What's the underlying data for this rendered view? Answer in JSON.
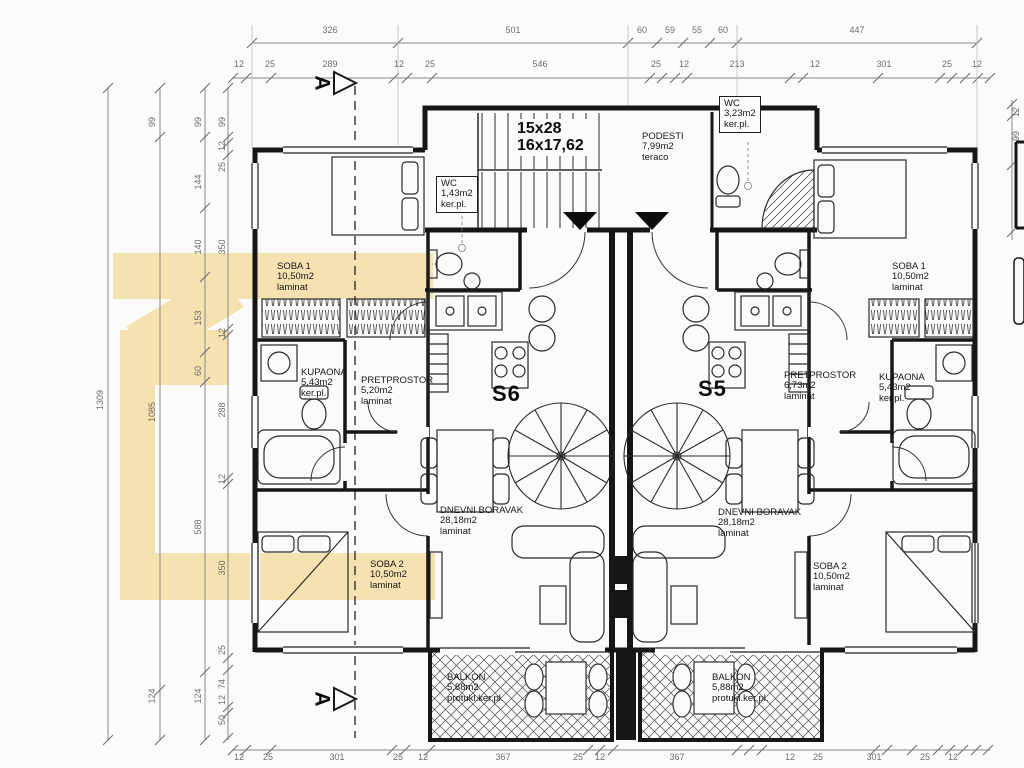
{
  "colors": {
    "watermark": "#f6e1b0",
    "wall": "#161616",
    "dimension_text": "#6e6e6e",
    "paper": "#fbfbfa"
  },
  "stair": {
    "line1": "15x28",
    "line2": "16x17,62"
  },
  "apartments": [
    {
      "id": "S6",
      "x": 492,
      "y": 381
    },
    {
      "id": "S5",
      "x": 698,
      "y": 376
    }
  ],
  "section_markers": [
    {
      "label": "A",
      "x": 314,
      "y": 70
    },
    {
      "label": "A",
      "x": 314,
      "y": 686
    }
  ],
  "rooms": [
    {
      "name": "SOBA 1",
      "area": "10,50m2",
      "floor": "laminat",
      "x": 277,
      "y": 262
    },
    {
      "name": "KUPAONA",
      "area": "5,43m2",
      "floor": "ker.pl.",
      "x": 301,
      "y": 368
    },
    {
      "name": "PRETPROSTOR",
      "area": "5,20m2",
      "floor": "laminat",
      "x": 361,
      "y": 376
    },
    {
      "name": "DNEVNI BORAVAK",
      "area": "28,18m2",
      "floor": "laminat",
      "x": 440,
      "y": 506
    },
    {
      "name": "SOBA 2",
      "area": "10,50m2",
      "floor": "laminat",
      "x": 370,
      "y": 560
    },
    {
      "name": "BALKON",
      "area": "5,88m2",
      "floor": "protukl.ker.pl.",
      "x": 447,
      "y": 673
    },
    {
      "name": "WC",
      "area": "1,43m2",
      "floor": "ker.pl.",
      "x": 436,
      "y": 176,
      "cls": "boxed"
    },
    {
      "name": "PODESTI",
      "area": "7,99m2",
      "floor": "teraco",
      "x": 642,
      "y": 132
    },
    {
      "name": "WC",
      "area": "3,23m2",
      "floor": "ker.pl.",
      "x": 719,
      "y": 96,
      "cls": "boxed"
    },
    {
      "name": "SOBA 1",
      "area": "10,50m2",
      "floor": "laminat",
      "x": 892,
      "y": 262
    },
    {
      "name": "PRETPROSTOR",
      "area": "6,73m2",
      "floor": "laminat",
      "x": 784,
      "y": 371
    },
    {
      "name": "KUPAONA",
      "area": "5,43m2",
      "floor": "ker.pl.",
      "x": 879,
      "y": 373
    },
    {
      "name": "DNEVNI BORAVAK",
      "area": "28,18m2",
      "floor": "laminat",
      "x": 718,
      "y": 508
    },
    {
      "name": "SOBA 2",
      "area": "10,50m2",
      "floor": "laminat",
      "x": 813,
      "y": 562
    },
    {
      "name": "BALKON",
      "area": "5,88m2",
      "floor": "protukl.ker.pl.",
      "x": 712,
      "y": 673
    }
  ],
  "dims": {
    "top_row1": [
      {
        "t": "326",
        "x": 330,
        "y": 30
      },
      {
        "t": "501",
        "x": 513,
        "y": 30
      },
      {
        "t": "60",
        "x": 642,
        "y": 30
      },
      {
        "t": "59",
        "x": 670,
        "y": 30
      },
      {
        "t": "55",
        "x": 697,
        "y": 30
      },
      {
        "t": "60",
        "x": 723,
        "y": 30
      },
      {
        "t": "447",
        "x": 857,
        "y": 30
      }
    ],
    "top_row2": [
      {
        "t": "12",
        "x": 239,
        "y": 64
      },
      {
        "t": "25",
        "x": 270,
        "y": 64
      },
      {
        "t": "289",
        "x": 330,
        "y": 64
      },
      {
        "t": "12",
        "x": 399,
        "y": 64
      },
      {
        "t": "25",
        "x": 430,
        "y": 64
      },
      {
        "t": "546",
        "x": 540,
        "y": 64
      },
      {
        "t": "25",
        "x": 656,
        "y": 64
      },
      {
        "t": "12",
        "x": 684,
        "y": 64
      },
      {
        "t": "213",
        "x": 737,
        "y": 64
      },
      {
        "t": "12",
        "x": 815,
        "y": 64
      },
      {
        "t": "301",
        "x": 884,
        "y": 64
      },
      {
        "t": "25",
        "x": 947,
        "y": 64
      },
      {
        "t": "12",
        "x": 977,
        "y": 64
      }
    ],
    "bottom": [
      {
        "t": "12",
        "x": 239,
        "y": 757
      },
      {
        "t": "25",
        "x": 268,
        "y": 757
      },
      {
        "t": "301",
        "x": 337,
        "y": 757
      },
      {
        "t": "25",
        "x": 398,
        "y": 757
      },
      {
        "t": "12",
        "x": 423,
        "y": 757
      },
      {
        "t": "367",
        "x": 503,
        "y": 757
      },
      {
        "t": "25",
        "x": 578,
        "y": 757
      },
      {
        "t": "12",
        "x": 600,
        "y": 757
      },
      {
        "t": "367",
        "x": 677,
        "y": 757
      },
      {
        "t": "12",
        "x": 790,
        "y": 757
      },
      {
        "t": "25",
        "x": 818,
        "y": 757
      },
      {
        "t": "301",
        "x": 874,
        "y": 757
      },
      {
        "t": "25",
        "x": 925,
        "y": 757
      },
      {
        "t": "12",
        "x": 953,
        "y": 757
      }
    ],
    "left_cols": [
      {
        "t": "1309",
        "x": 100,
        "y": 400
      },
      {
        "t": "99",
        "x": 152,
        "y": 122
      },
      {
        "t": "1085",
        "x": 152,
        "y": 412
      },
      {
        "t": "124",
        "x": 152,
        "y": 696
      },
      {
        "t": "99",
        "x": 198,
        "y": 122
      },
      {
        "t": "144",
        "x": 198,
        "y": 182
      },
      {
        "t": "140",
        "x": 198,
        "y": 247
      },
      {
        "t": "153",
        "x": 198,
        "y": 318
      },
      {
        "t": "60",
        "x": 198,
        "y": 371
      },
      {
        "t": "588",
        "x": 198,
        "y": 527
      },
      {
        "t": "124",
        "x": 198,
        "y": 696
      },
      {
        "t": "99",
        "x": 222,
        "y": 122
      },
      {
        "t": "12",
        "x": 222,
        "y": 146
      },
      {
        "t": "25",
        "x": 222,
        "y": 167
      },
      {
        "t": "350",
        "x": 222,
        "y": 247
      },
      {
        "t": "12",
        "x": 222,
        "y": 333
      },
      {
        "t": "288",
        "x": 222,
        "y": 410
      },
      {
        "t": "12",
        "x": 222,
        "y": 479
      },
      {
        "t": "350",
        "x": 222,
        "y": 568
      },
      {
        "t": "25",
        "x": 222,
        "y": 650
      },
      {
        "t": "74",
        "x": 222,
        "y": 684
      },
      {
        "t": "12",
        "x": 222,
        "y": 700
      },
      {
        "t": "50",
        "x": 222,
        "y": 720
      }
    ],
    "right_col": [
      {
        "t": "12",
        "x": 1016,
        "y": 112
      },
      {
        "t": "99",
        "x": 1016,
        "y": 136
      }
    ]
  }
}
